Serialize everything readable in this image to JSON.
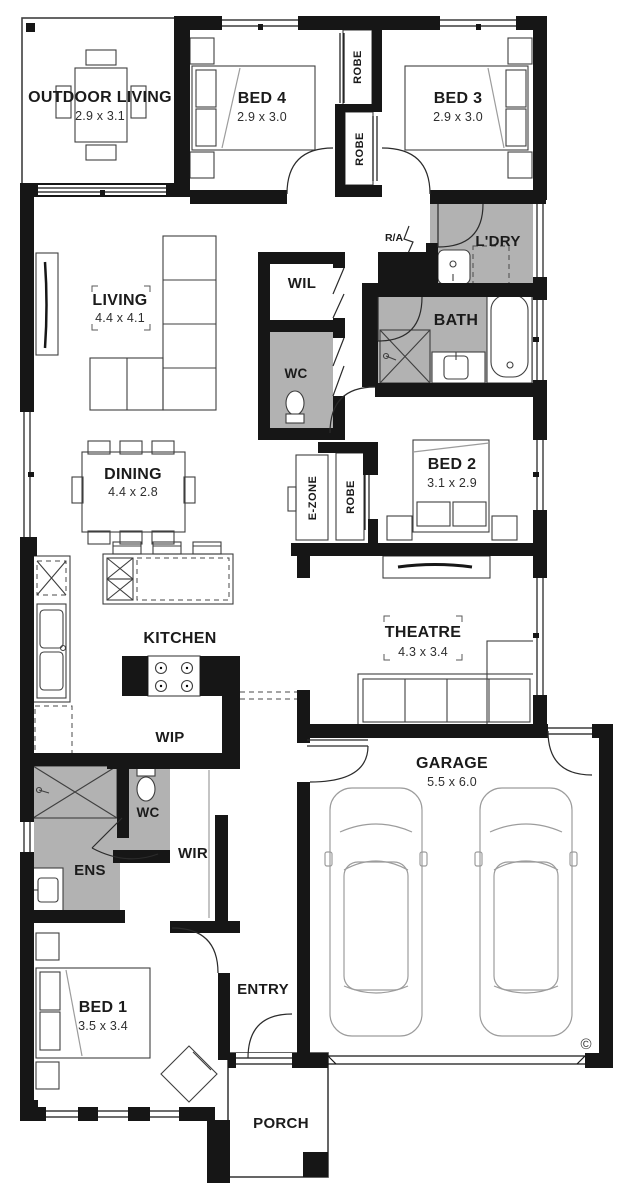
{
  "plan": {
    "colors": {
      "wall": "#161616",
      "wet_area": "#b2b2b2",
      "paper": "#ffffff",
      "line": "#2b2b2b"
    },
    "rooms": {
      "outdoor_living": {
        "label": "OUTDOOR LIVING",
        "dims": "2.9 x 3.1"
      },
      "bed4": {
        "label": "BED 4",
        "dims": "2.9 x 3.0"
      },
      "bed3": {
        "label": "BED 3",
        "dims": "2.9 x 3.0"
      },
      "robe_bed4": {
        "label": "ROBE"
      },
      "robe_bed3": {
        "label": "ROBE"
      },
      "ra": {
        "label": "R/A"
      },
      "ldry": {
        "label": "L'DRY"
      },
      "living": {
        "label": "LIVING",
        "dims": "4.4 x 4.1"
      },
      "wil": {
        "label": "WIL"
      },
      "bath": {
        "label": "BATH"
      },
      "wc_main": {
        "label": "WC"
      },
      "dining": {
        "label": "DINING",
        "dims": "4.4 x 2.8"
      },
      "ezone": {
        "label": "E-ZONE"
      },
      "robe_bed2": {
        "label": "ROBE"
      },
      "bed2": {
        "label": "BED 2",
        "dims": "3.1 x 2.9"
      },
      "kitchen": {
        "label": "KITCHEN"
      },
      "theatre": {
        "label": "THEATRE",
        "dims": "4.3 x 3.4"
      },
      "wip": {
        "label": "WIP"
      },
      "garage": {
        "label": "GARAGE",
        "dims": "5.5 x 6.0"
      },
      "wc_ens": {
        "label": "WC"
      },
      "wir": {
        "label": "WIR"
      },
      "ens": {
        "label": "ENS"
      },
      "bed1": {
        "label": "BED 1",
        "dims": "3.5 x 3.4"
      },
      "entry": {
        "label": "ENTRY"
      },
      "porch": {
        "label": "PORCH"
      }
    },
    "marks": {
      "copyright": "©"
    }
  }
}
